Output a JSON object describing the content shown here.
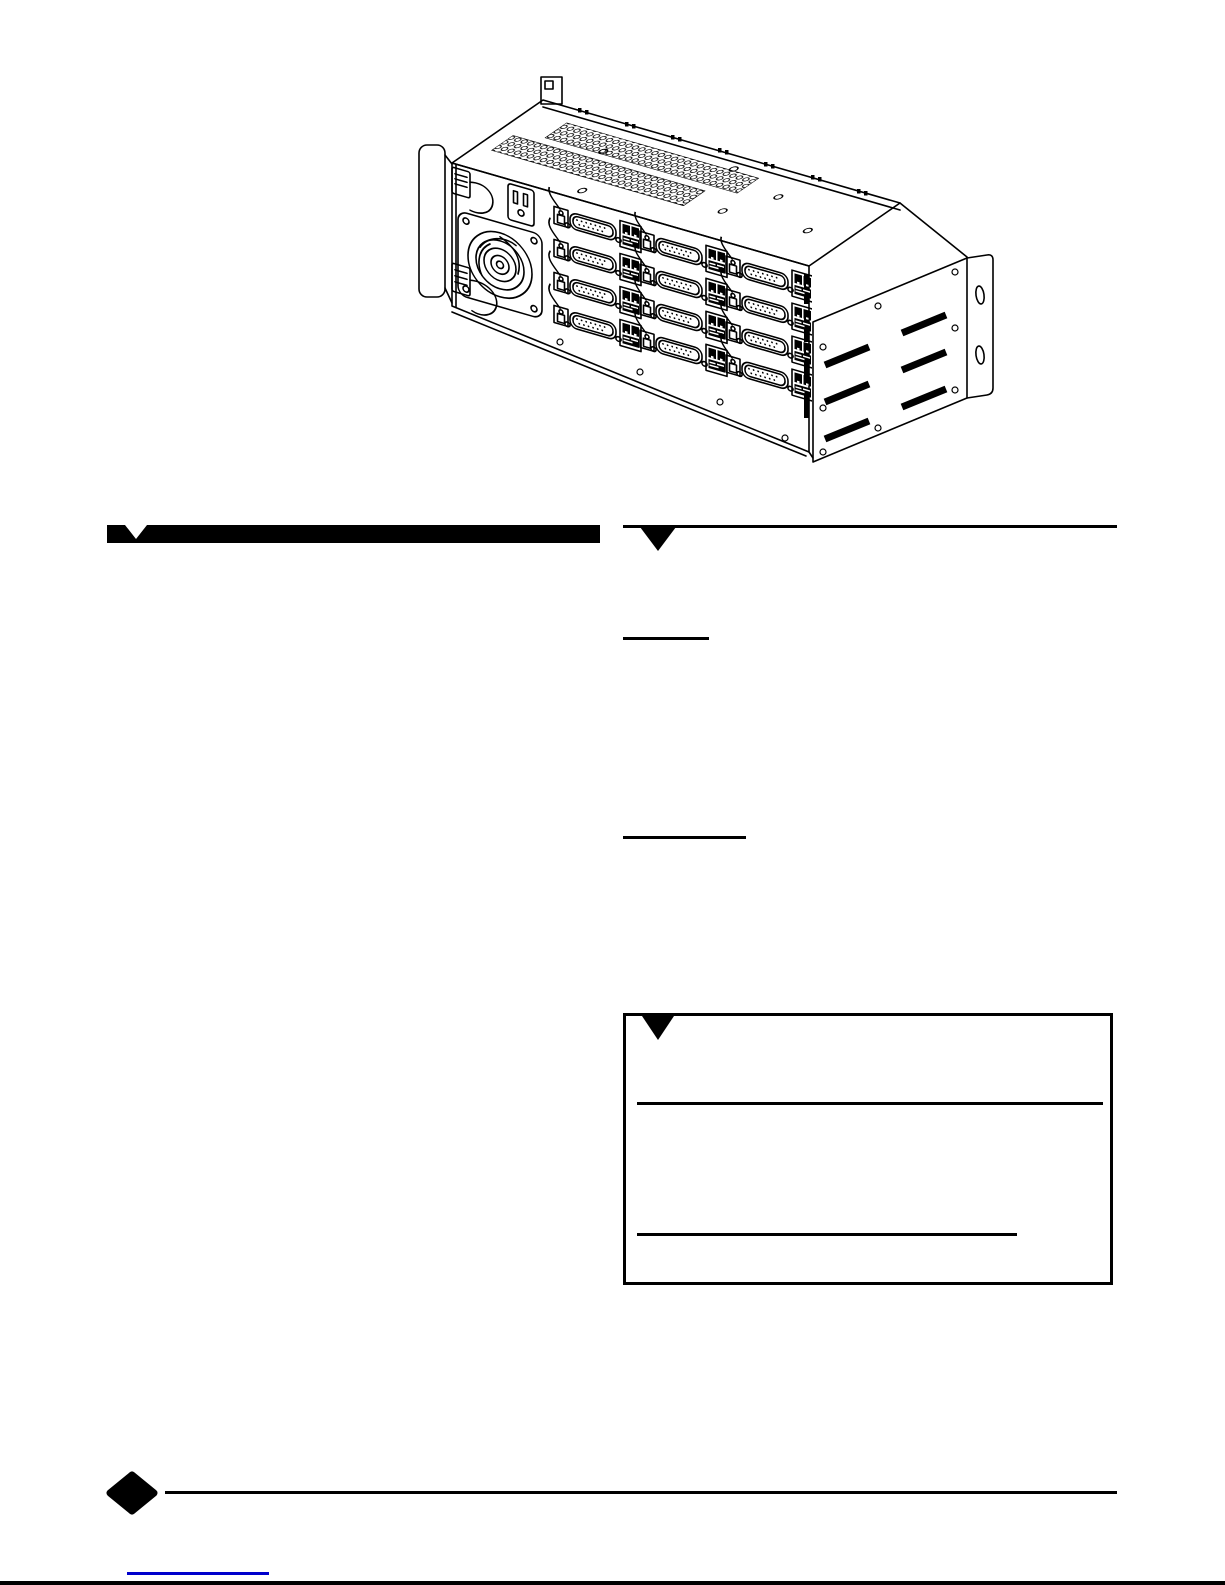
{
  "document": {
    "type": "hardware-manual-page",
    "visible_text": "",
    "columns": 2
  },
  "colors": {
    "paper": "#ffffff",
    "ink": "#000000",
    "link": "#0000cc"
  },
  "illustration": {
    "name": "rack-chassis-rear-isometric-view",
    "features": [
      "left-rack-mount-ear",
      "power-supply-fan",
      "ac-power-outlet",
      "power-cable-plugs",
      "db25-connector-grid-4-rows-3-columns",
      "rj45-jack-pairs",
      "latch-plugs-with-cables",
      "top-honeycomb-vent-strips",
      "rear-top-rail-with-square-holes",
      "right-side-panel-diagonal-vent-slots",
      "right-rack-mount-ear-with-oval-slots"
    ]
  },
  "markers": {
    "left_header": "notched-black-banner",
    "right_header": "rule-with-down-triangle-marker",
    "note_box": "outlined-box-with-down-triangle-and-two-rules",
    "footer": "black-diamond-with-rule",
    "footer_link": "blue-underline"
  }
}
